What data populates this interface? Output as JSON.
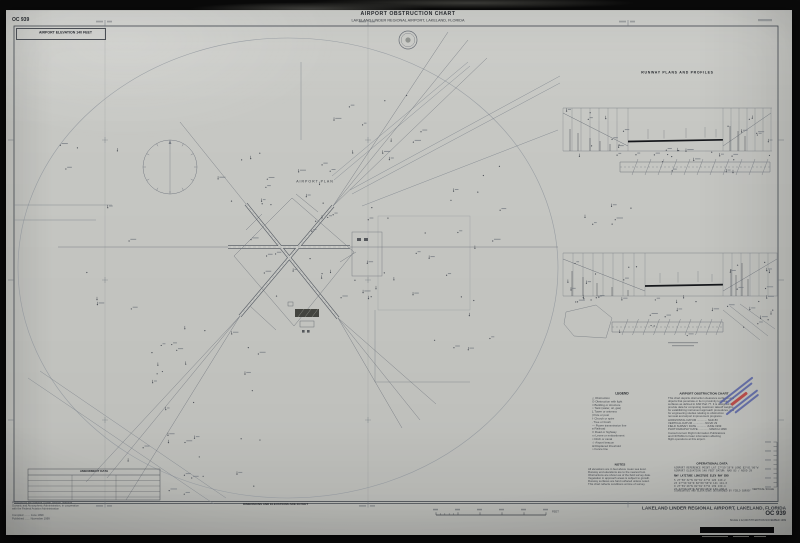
{
  "header": {
    "chart_no": "OC 939",
    "title": "AIRPORT OBSTRUCTION CHART",
    "subtitle": "LAKELAND LINDER REGIONAL AIRPORT, LAKELAND, FLORIDA",
    "elevation_note": "AIRPORT ELEVATION 140 FEET"
  },
  "plan": {
    "label": "AIRPORT PLAN"
  },
  "profiles": {
    "title": "RUNWAY PLANS AND PROFILES"
  },
  "legend": {
    "title": "LEGEND",
    "items": [
      "△  Obstruction",
      "⊙  Obstruction with light",
      "□  Building or structure",
      "○  Tank (water, oil, gas)",
      "Ʇ  Tower or antenna",
      "|  Pole or post",
      "†  Church or spire",
      "∙  Tree or brush",
      "—  Power transmission line",
      "≡  Railroad",
      "═  Road or highway",
      "▭  Levee or embankment",
      "≈  Ditch or canal",
      "☆  Airport beacon",
      "⊞  Displaced threshold",
      "⌁  Fence line"
    ]
  },
  "description": {
    "title": "AIRPORT OBSTRUCTION CHART",
    "lines": [
      "This chart depicts obstruction clearance surfaces and",
      "objects that penetrate or lie in proximity to those",
      "surfaces as defined in FAR Part 77. It is designed to",
      "provide data for computing maximum takeoff weights,",
      "for establishing instrument approach procedures, and",
      "for engineering studies relating to obstruction",
      "removal and airport improvement programs."
    ],
    "refs": [
      "HORIZONTAL DATUM ............. NAD 83",
      "VERTICAL DATUM ............... NGVD 29",
      "FIELD SURVEY DATE ............ JUNE 1999",
      "PHOTOGRAPHY DATE ............. MARCH 1999"
    ],
    "extra": [
      "Consult current Flight Information Publications",
      "and NOTAMs for later information affecting",
      "flight operations at this airport."
    ]
  },
  "notes": {
    "title": "NOTES",
    "lines": [
      "All elevations are in feet above mean sea level.",
      "Runway end elevations are to the nearest foot.",
      "Obstructions are shown as of the field survey date.",
      "Vegetation in approach areas is subject to growth.",
      "Runway surfaces are hard surfaced unless noted.",
      "This chart reflects conditions at time of survey."
    ]
  },
  "operational": {
    "title": "OPERATIONAL DATA",
    "subtitle_lines": [
      "AIRPORT REFERENCE POINT   LAT 27°59'19\"N  LONG 82°01'06\"W",
      "AIRPORT ELEVATION 140 FEET        DATUM: NAD 83 / NGVD 29"
    ],
    "header_row": "RWY    LATITUDE       LONGITUDE      ELEV   RWY END",
    "rows": [
      " 5     27°58'32\"N    82°01'47\"W    126    140.2",
      "23     27°59'04\"N    82°00'50\"W    141    141.0",
      " 9     27°59'20\"N    82°01'37\"W    139    139.4",
      "27     27°59'20\"N    82°00'33\"W    133    138.6"
    ],
    "footnote": "COORDINATES AND ELEVATIONS DETERMINED BY FIELD SURVEY"
  },
  "amendment": {
    "title": "AMENDMENT DATA"
  },
  "publisher": {
    "lines": [
      "Produced by the National Ocean Service, National",
      "Oceanic and Atmospheric Administration, in cooperation",
      "with the Federal Aviation Administration"
    ],
    "meta": [
      "Compiled ........ June 1999",
      "Published ....... November 1999"
    ]
  },
  "footer": {
    "dimensions_note": "DIMENSIONS AND ELEVATIONS ARE IN FEET",
    "airport": "LAKELAND LINDER REGIONAL AIRPORT, LAKELAND, FLORIDA",
    "chart_no": "OC 939",
    "scale_note": "SCALE 1:12,000    5TH EDITION    NOVEMBER 1999",
    "feet_label": "FEET",
    "vertical_scale_label": "VERTICAL SCALE"
  },
  "stamp": {
    "blue": "#5a64a0",
    "red": "#b4403e"
  },
  "colors": {
    "paper": "#c7c8c4",
    "photo_bg": "#0a0a0a",
    "linework": "#6b7078"
  }
}
